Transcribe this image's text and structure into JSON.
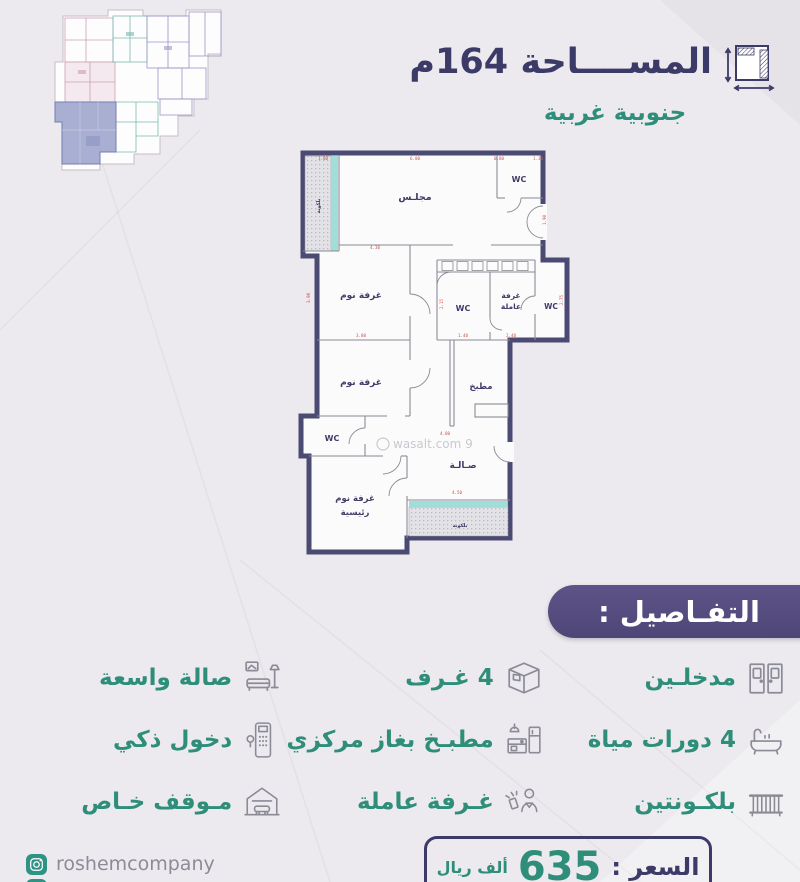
{
  "header": {
    "area_title": "المســــاحة 164م",
    "orientation": "جنوبية غربية",
    "area_icon": "dimensions-icon"
  },
  "plan": {
    "watermark": "wasalt.com 9",
    "rooms": [
      {
        "label": "مجلـس"
      },
      {
        "label": "WC"
      },
      {
        "label": "بلكونة"
      },
      {
        "label": "غرفة نوم"
      },
      {
        "label": "WC"
      },
      {
        "label": "غرفة"
      },
      {
        "label": "عاملة"
      },
      {
        "label": "WC"
      },
      {
        "label": "مطبخ"
      },
      {
        "label": "غرفة نوم"
      },
      {
        "label": "WC"
      },
      {
        "label": "صـالـة"
      },
      {
        "label": "غرفة نوم"
      },
      {
        "label": "رئيسية"
      },
      {
        "label": "بلكونة"
      }
    ],
    "dims": [
      {
        "t": "1.00"
      },
      {
        "t": "6.00"
      },
      {
        "t": "0.80"
      },
      {
        "t": "1.30"
      },
      {
        "t": "1.90"
      },
      {
        "t": "4.30"
      },
      {
        "t": "3.90"
      },
      {
        "t": "2.15"
      },
      {
        "t": "1.40"
      },
      {
        "t": "2.40"
      },
      {
        "t": "2.75"
      },
      {
        "t": "4.00"
      },
      {
        "t": "4.50"
      },
      {
        "t": "3.80"
      }
    ]
  },
  "details": {
    "title": "التفـاصيل :"
  },
  "features": [
    {
      "label": "مدخلـين",
      "icon": "double-door-icon"
    },
    {
      "label": "4 غـرف",
      "icon": "rooms-cube-icon"
    },
    {
      "label": "صالة واسعة",
      "icon": "sofa-icon"
    },
    {
      "label": "4 دورات مياة",
      "icon": "bathtub-icon"
    },
    {
      "label": "مطبـخ بغاز مركزي",
      "icon": "kitchen-icon"
    },
    {
      "label": "دخول ذكي",
      "icon": "smart-lock-icon"
    },
    {
      "label": "بلكـونتين",
      "icon": "balcony-icon"
    },
    {
      "label": "غـرفة عاملة",
      "icon": "maid-icon"
    },
    {
      "label": "مـوقف خـاص",
      "icon": "garage-icon"
    }
  ],
  "price": {
    "label": "السعر :",
    "value": "635",
    "unit": "ألف ريال"
  },
  "footer": {
    "company": "roshemcompany"
  },
  "colors": {
    "navy": "#3C3A67",
    "teal_text": "#2E8E7A",
    "banner_purple": "#584E82",
    "wall": "#4A4A72",
    "dim_red": "#C9554F",
    "balcony_teal": "#8FD8D2",
    "logo_teal": "#2F9384",
    "icon_gray": "#8B8B97",
    "background": "#ECEAEE",
    "highlight_unit": "#98A0CA"
  }
}
